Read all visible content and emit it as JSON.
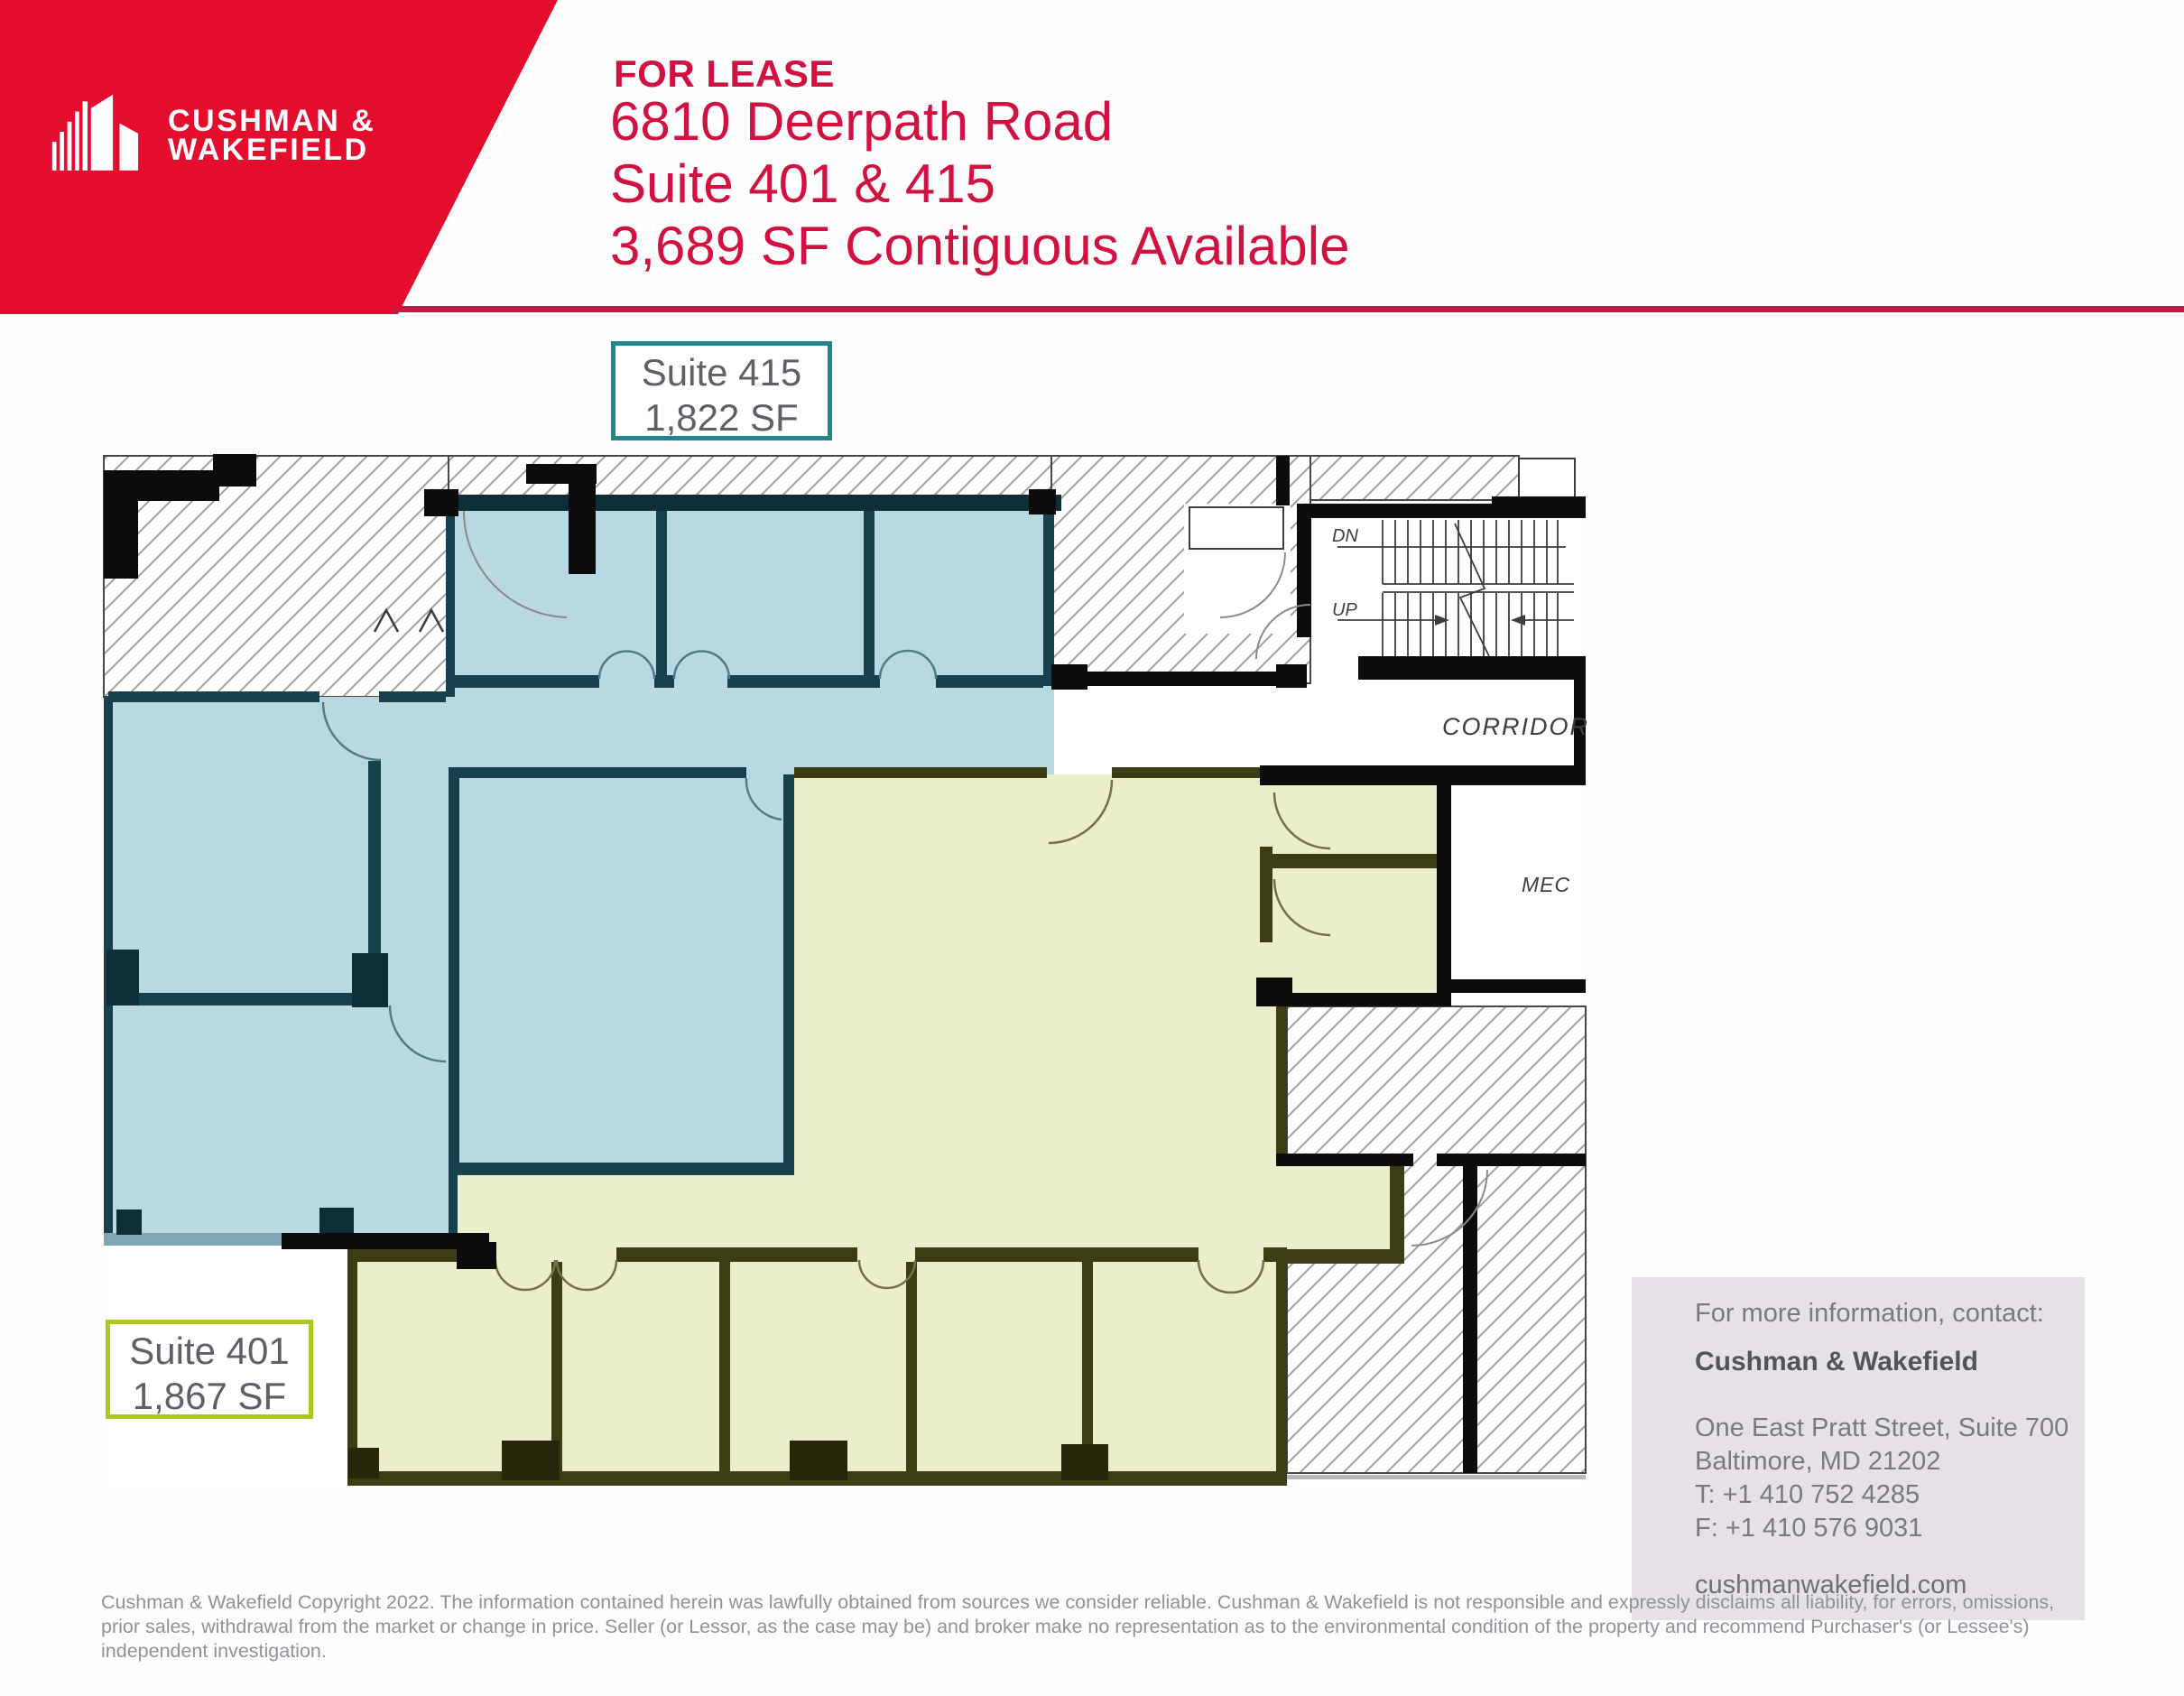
{
  "brand": {
    "name_line1": "CUSHMAN &",
    "name_line2": "WAKEFIELD"
  },
  "header": {
    "eyebrow": "FOR LEASE",
    "address": "6810 Deerpath Road",
    "suites": "Suite 401 & 415",
    "availability": "3,689 SF Contiguous Available"
  },
  "suite_labels": [
    {
      "name": "Suite 415",
      "area": "1,822 SF",
      "accent_color": "#1e8691",
      "fill_color": "#b8d9e2"
    },
    {
      "name": "Suite 401",
      "area": "1,867 SF",
      "accent_color": "#abc81f",
      "fill_color": "#ebeeca"
    }
  ],
  "floor_plan": {
    "corridor": "CORRIDOR",
    "mechanical": "MEC",
    "stair_down": "DN",
    "stair_up": "UP"
  },
  "contact": {
    "intro": "For more information, contact:",
    "company": "Cushman & Wakefield",
    "address1": "One East Pratt Street, Suite 700",
    "address2": "Baltimore, MD 21202",
    "phone": "T: +1 410 752 4285",
    "fax": "F: +1 410 576 9031",
    "website": "cushmanwakefield.com"
  },
  "disclaimer": "Cushman & Wakefield Copyright 2022. The information contained herein was lawfully obtained from sources we consider reliable. Cushman & Wakefield is not responsible and expressly disclaims all liability, for errors, omissions, prior sales, withdrawal from the market or change in price. Seller (or Lessor, as the case may be) and broker make no representation as to the environmental condition of the property and recommend Purchaser's (or Lessee's) independent investigation.",
  "colors": {
    "brand_red": "#e50d2e",
    "header_text_red": "#d1113f",
    "contact_bg": "#e5e1e6",
    "suite_415_wall": "#16414d",
    "suite_401_wall": "#3c3d12"
  }
}
